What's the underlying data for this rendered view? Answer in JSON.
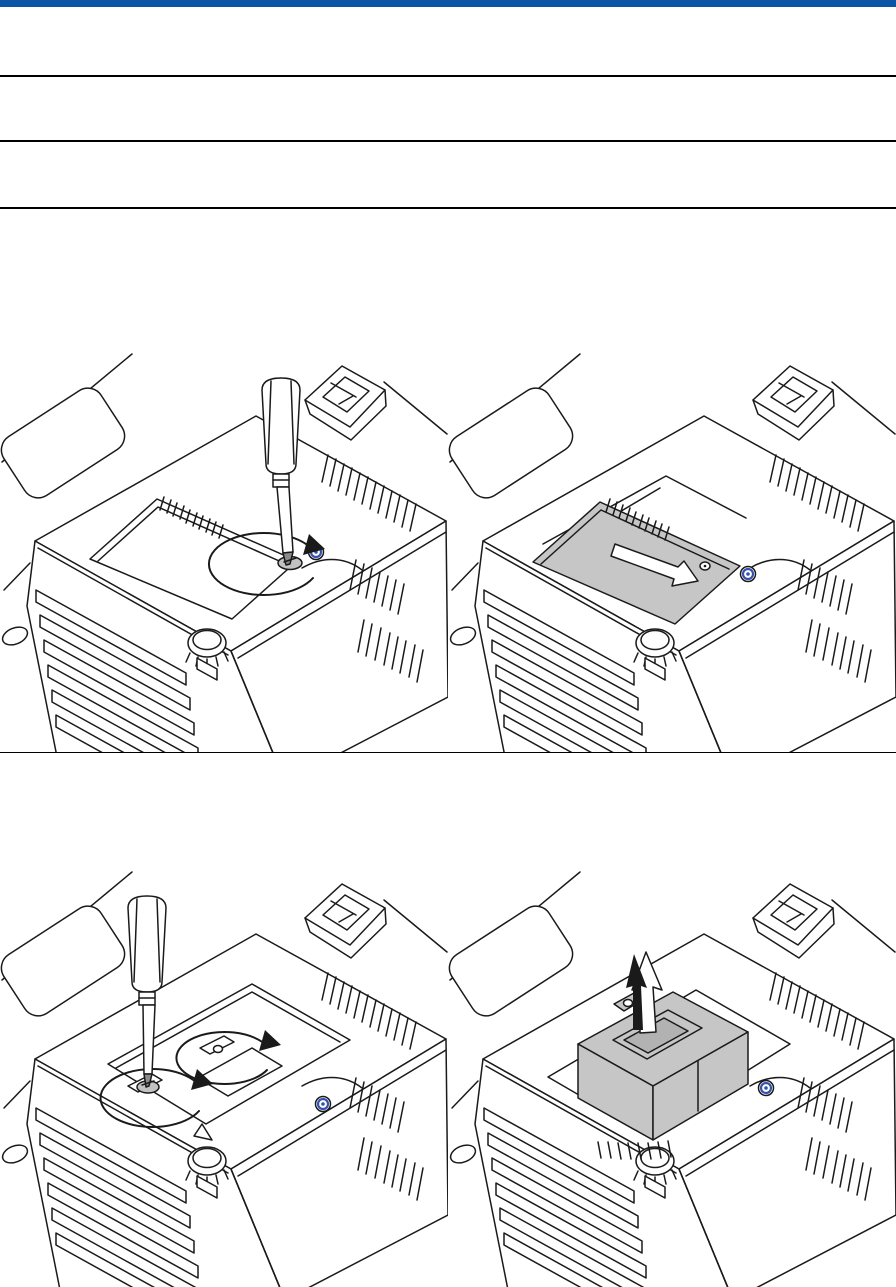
{
  "header": {
    "bar_color": "#0b54a6",
    "bar_height_px": 7
  },
  "rules": {
    "color": "#000000",
    "y_positions": [
      75,
      140,
      207
    ],
    "thickness_px": 2,
    "row_divider_y": 752,
    "row_divider_thickness_px": 1
  },
  "colors": {
    "background": "#ffffff",
    "line_art": "#1a1a1a",
    "shaded_fill": "#c6c6c6",
    "shaded_fill_dark": "#b2b2b2",
    "metal_gray": "#8c8c8c",
    "pad_gray": "#c2c2c2",
    "screw_accent": "#3553ae"
  },
  "figures": [
    {
      "id": "figure-1",
      "position": "top-left",
      "icons": [
        "projector-illustration",
        "screwdriver-icon",
        "rotate-ccw-arrow-icon",
        "lamp-cover",
        "blue-screw-icon"
      ]
    },
    {
      "id": "figure-2",
      "position": "top-right",
      "icons": [
        "projector-illustration",
        "lamp-cover-shaded",
        "slide-direction-arrow-icon",
        "blue-screw-icon"
      ]
    },
    {
      "id": "figure-3",
      "position": "bottom-left",
      "icons": [
        "projector-illustration",
        "screwdriver-icon",
        "rotate-ccw-arrow-icon",
        "rotate-ccw-arrow-icon",
        "lamp-compartment",
        "blue-screw-icon"
      ]
    },
    {
      "id": "figure-4",
      "position": "bottom-right",
      "icons": [
        "projector-illustration",
        "lamp-housing-shaded",
        "lift-direction-arrow-icon",
        "blue-screw-icon"
      ]
    }
  ]
}
